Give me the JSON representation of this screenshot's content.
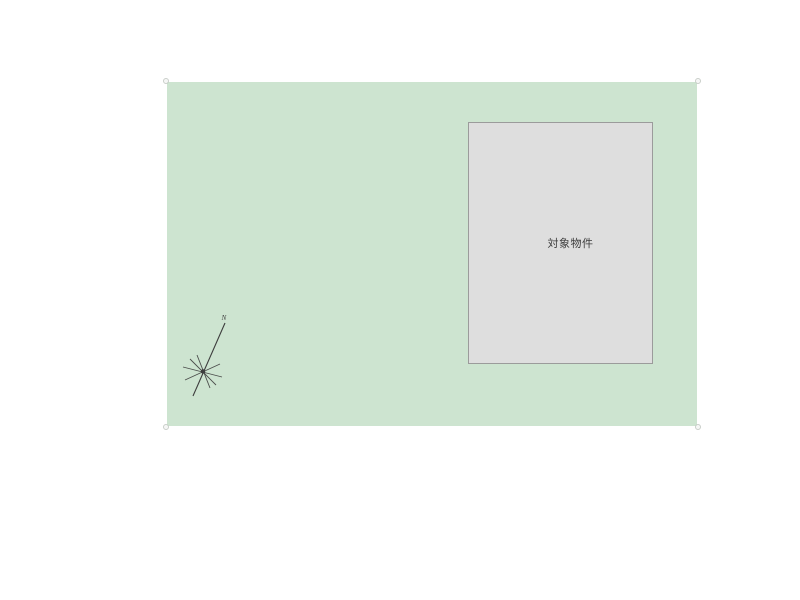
{
  "colors": {
    "background": "#ffffff",
    "site-fill": "#cde4d0",
    "building-fill": "#dedede",
    "building-border": "#9b9b9b",
    "handle-border": "#c4c9c4",
    "compass-stroke": "#3d3d3d",
    "text-color": "#3c3c3c"
  },
  "building": {
    "label": "対象物件"
  },
  "compass": {
    "north_label": "N"
  }
}
